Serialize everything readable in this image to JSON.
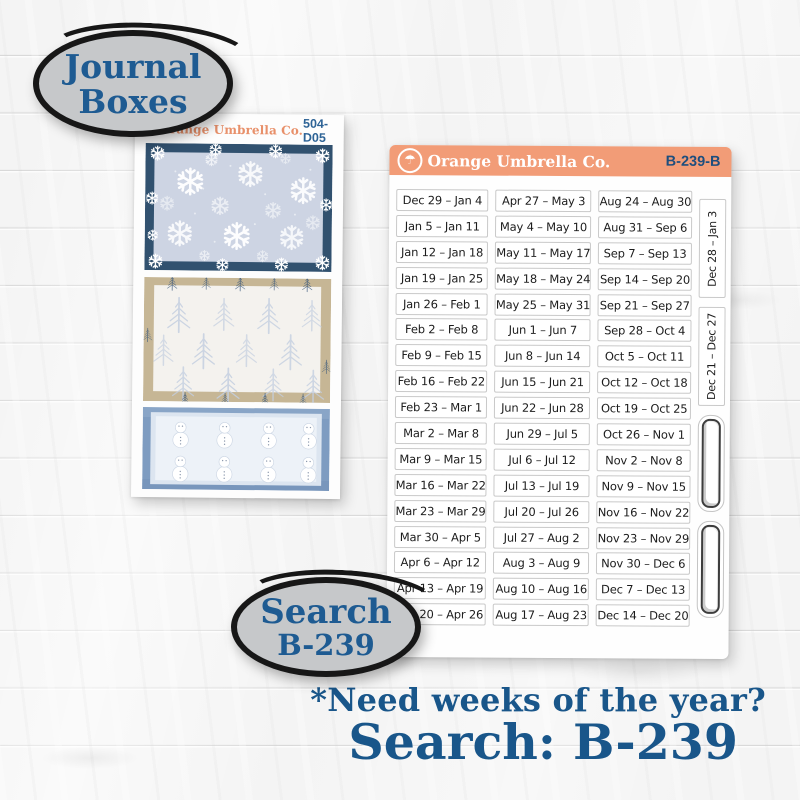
{
  "badges": {
    "journal_boxes": {
      "line1": "Journal",
      "line2": "Boxes"
    },
    "search": {
      "line1": "Search",
      "line2": "B-239"
    }
  },
  "left_sheet": {
    "brand": "Orange Umbrella Co.",
    "code": "504-D05",
    "logo_icon": "umbrella-icon",
    "boxes": [
      "snowflakes-pattern",
      "pine-trees-pattern",
      "snowmen-pattern"
    ]
  },
  "right_sheet": {
    "brand": "Orange Umbrella Co.",
    "code": "B-239-B",
    "logo_icon": "umbrella-icon",
    "columns": [
      [
        "Dec 29 – Jan 4",
        "Jan 5 – Jan 11",
        "Jan 12 – Jan 18",
        "Jan 19 – Jan 25",
        "Jan 26 – Feb 1",
        "Feb 2 – Feb 8",
        "Feb 9 – Feb 15",
        "Feb 16 – Feb 22",
        "Feb 23 – Mar 1",
        "Mar 2 – Mar 8",
        "Mar 9 – Mar 15",
        "Mar 16 – Mar 22",
        "Mar 23 – Mar 29",
        "Mar 30 – Apr 5",
        "Apr 6 – Apr 12",
        "Apr 13 – Apr 19",
        "Apr 20 – Apr 26"
      ],
      [
        "Apr 27 – May 3",
        "May 4 – May 10",
        "May 11 – May 17",
        "May 18 – May 24",
        "May 25 – May 31",
        "Jun 1 – Jun 7",
        "Jun 8 – Jun 14",
        "Jun 15 – Jun 21",
        "Jun 22 – Jun 28",
        "Jun 29 – Jul 5",
        "Jul 6 – Jul 12",
        "Jul 13 – Jul 19",
        "Jul 20 – Jul 26",
        "Jul 27 – Aug 2",
        "Aug 3 – Aug 9",
        "Aug 10 – Aug 16",
        "Aug 17 – Aug 23"
      ],
      [
        "Aug 24 – Aug 30",
        "Aug 31 – Sep 6",
        "Sep 7 – Sep 13",
        "Sep 14 – Sep 20",
        "Sep 21 – Sep 27",
        "Sep 28 – Oct 4",
        "Oct 5 – Oct 11",
        "Oct 12 – Oct 18",
        "Oct 19 – Oct 25",
        "Oct 26 – Nov 1",
        "Nov 2 – Nov 8",
        "Nov 9 – Nov 15",
        "Nov 16 – Nov 22",
        "Nov 23 – Nov 29",
        "Nov 30 – Dec 6",
        "Dec 7 – Dec 13",
        "Dec 14 – Dec 20"
      ]
    ],
    "side_labels": [
      "Dec 28 – Jan 3",
      "Dec 21 – Dec 27"
    ]
  },
  "footer": {
    "line1": "*Need weeks of the year?",
    "line2": "Search: B-239"
  },
  "colors": {
    "accent_salmon": "#F29C77",
    "brand_orange": "#E8906A",
    "badge_blue": "#1E5B92",
    "footer_blue": "#19568A",
    "code_blue": "#1D4E7E",
    "navy_border": "#31516F",
    "tan_border": "#C6B695",
    "blue_border": "#7E9CC1",
    "badge_gray": "#C6C8CA"
  }
}
